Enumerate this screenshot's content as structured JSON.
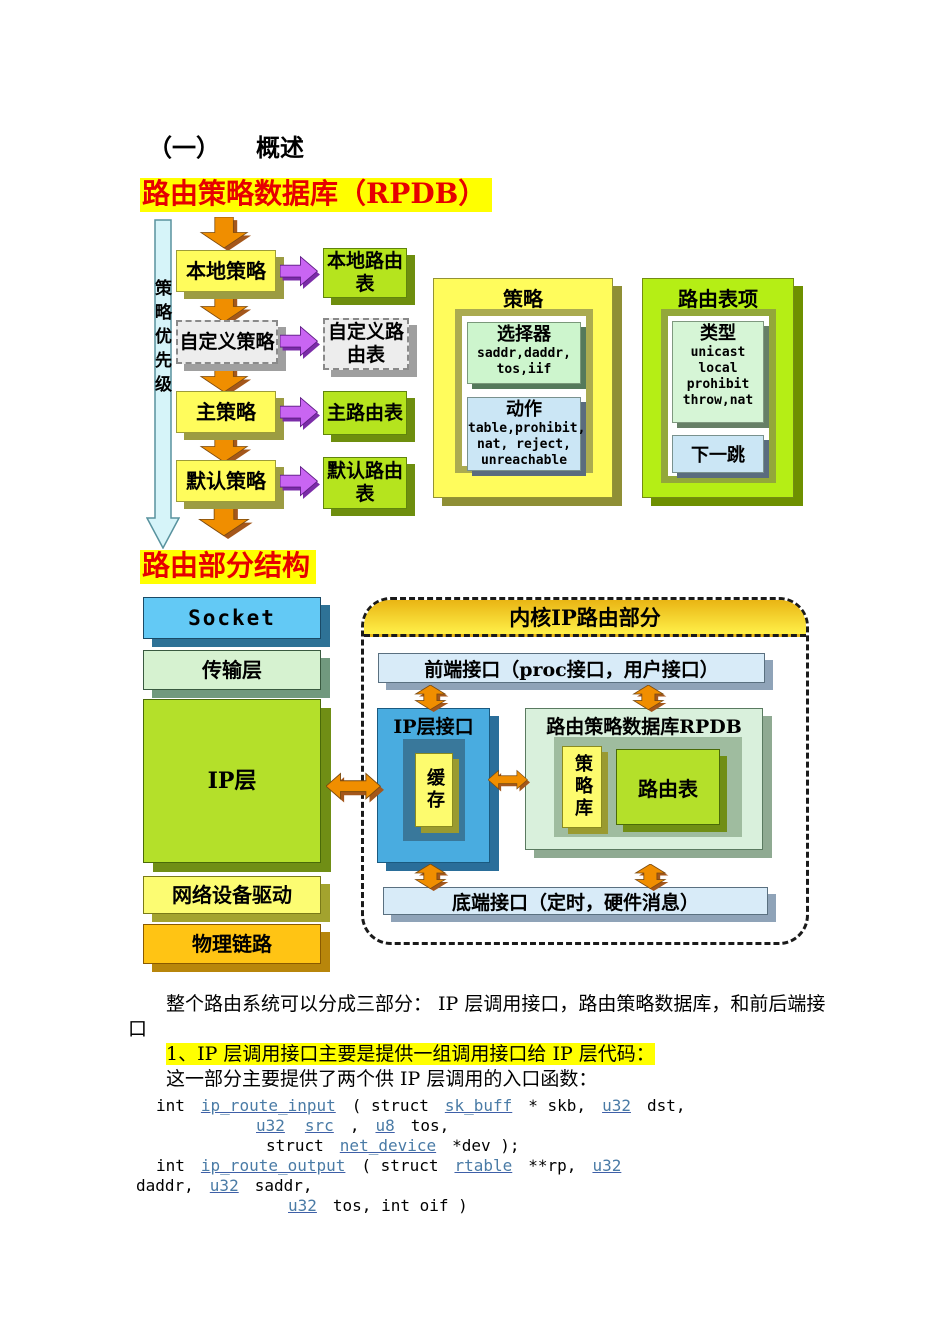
{
  "heading": {
    "num": "（一）",
    "title": "概述"
  },
  "section1_title": "路由策略数据库（RPDB）",
  "section2_title": "路由部分结构",
  "diagram1": {
    "priority_label": "策略优先级",
    "policies": [
      "本地策略",
      "自定义策略",
      "主策略",
      "默认策略"
    ],
    "tables": [
      "本地路由表",
      "自定义路由表",
      "主路由表",
      "默认路由表"
    ],
    "policy_box": {
      "title": "策略",
      "selector_title": "选择器",
      "selector_lines": [
        "saddr,daddr,",
        "tos,iif"
      ],
      "action_title": "动作",
      "action_lines": [
        "table,prohibit,",
        "nat, reject,",
        "unreachable"
      ]
    },
    "entry_box": {
      "title": "路由表项",
      "type_title": "类型",
      "type_lines": [
        "unicast",
        "local",
        "prohibit",
        "throw,nat"
      ],
      "nexthop": "下一跳"
    }
  },
  "diagram2": {
    "stack": [
      "Socket",
      "传输层",
      "IP层",
      "网络设备驱动",
      "物理链路"
    ],
    "container_title": "内核IP路由部分",
    "front_bar": "前端接口（proc接口，用户接口）",
    "ip_if_title": "IP层接口",
    "cache": "缓存",
    "rpdb_title": "路由策略数据库RPDB",
    "policy_lib": "策略库",
    "route_table": "路由表",
    "bottom_bar": "底端接口（定时，硬件消息）"
  },
  "body_text": {
    "para1": "整个路由系统可以分成三部分： IP 层调用接口，路由策略数据库，和前后端接口",
    "para2_highlight": "1、IP 层调用接口主要是提供一组调用接口给 IP 层代码：",
    "para3": "这一部分主要提供了两个供 IP 层调用的入口函数：",
    "code_lines": [
      {
        "segs": [
          {
            "c": "t",
            "v": "int"
          },
          {
            "c": "l",
            "v": "ip_route_input"
          },
          {
            "c": "t",
            "v": "( struct"
          },
          {
            "c": "l",
            "v": "sk_buff"
          },
          {
            "c": "t",
            "v": "* skb,"
          },
          {
            "c": "l",
            "v": "u32"
          },
          {
            "c": "t",
            "v": "dst,"
          }
        ]
      },
      {
        "segs": [
          {
            "c": "l",
            "v": "u32"
          },
          {
            "c": "l",
            "v": "src"
          },
          {
            "c": "t",
            "v": ","
          },
          {
            "c": "l",
            "v": "u8"
          },
          {
            "c": "t",
            "v": "tos,"
          }
        ]
      },
      {
        "segs": [
          {
            "c": "t",
            "v": "struct"
          },
          {
            "c": "l",
            "v": "net_device"
          },
          {
            "c": "t",
            "v": "*dev );"
          }
        ]
      },
      {
        "segs": [
          {
            "c": "t",
            "v": "int"
          },
          {
            "c": "l",
            "v": "ip_route_output"
          },
          {
            "c": "t",
            "v": "( struct"
          },
          {
            "c": "l",
            "v": "rtable"
          },
          {
            "c": "t",
            "v": "**rp,"
          },
          {
            "c": "l",
            "v": "u32"
          }
        ]
      },
      {
        "segs": [
          {
            "c": "t",
            "v": "daddr,"
          },
          {
            "c": "l",
            "v": "u32"
          },
          {
            "c": "t",
            "v": "saddr,"
          }
        ]
      },
      {
        "segs": [
          {
            "c": "l",
            "v": "u32"
          },
          {
            "c": "t",
            "v": "tos, int oif )"
          }
        ]
      }
    ]
  },
  "colors": {
    "accent_red": "#E60000",
    "highlight": "#FFFF00",
    "link": "#4A7BA6"
  }
}
